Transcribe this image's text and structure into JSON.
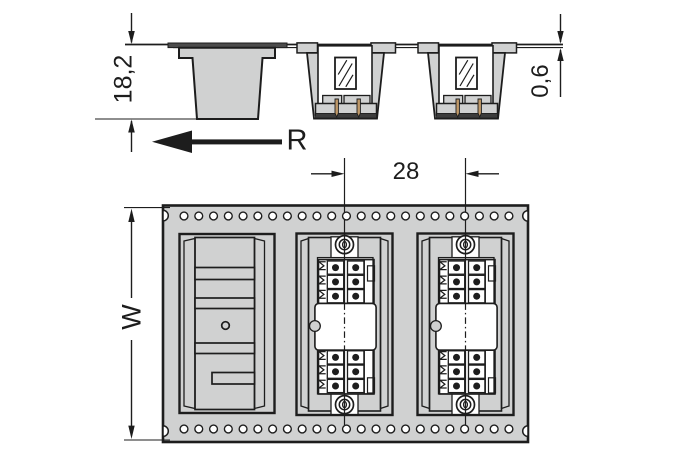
{
  "drawing": {
    "type": "technical-dimension-drawing",
    "views": [
      "side-section-view",
      "tape-top-view"
    ],
    "subject": "PCB terminal blocks packaged in blister carrier tape"
  },
  "labels": {
    "pocket_depth": "18,2",
    "tape_thickness": "0,6",
    "reel_direction": "R",
    "pocket_pitch": "28",
    "tape_width": "W"
  },
  "colors": {
    "line": "#1d1d1d",
    "tape_fill": "#d0d1d1",
    "white": "#ffffff",
    "pin": "#bf9868",
    "dark_band": "#3c3c3c",
    "lip_dark": "#4c4c4c",
    "background": "#ffffff"
  },
  "top_view": {
    "sprocket_holes": {
      "rows": 2,
      "count_per_row": 23,
      "start_x": 184,
      "spacing": 14.77,
      "top_y": 216,
      "bottom_y": 429,
      "radius": 3.9
    },
    "pockets": [
      {
        "type": "empty-pocket"
      },
      {
        "type": "connector-pocket",
        "contact_dots": 12,
        "screw_heads": 2
      },
      {
        "type": "connector-pocket",
        "contact_dots": 12,
        "screw_heads": 2
      }
    ]
  }
}
